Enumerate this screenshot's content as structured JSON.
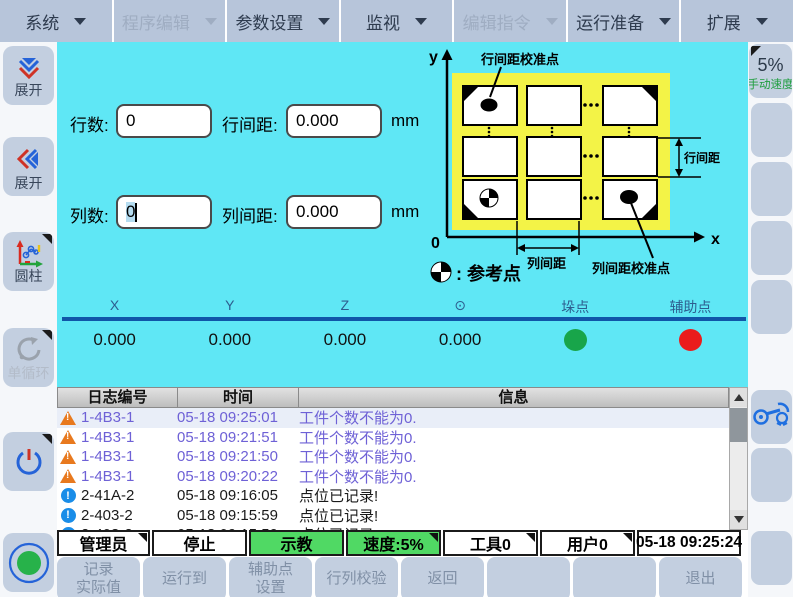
{
  "menu": {
    "items": [
      {
        "label": "系统",
        "disabled": false
      },
      {
        "label": "程序编辑",
        "disabled": true
      },
      {
        "label": "参数设置",
        "disabled": false
      },
      {
        "label": "监视",
        "disabled": false
      },
      {
        "label": "编辑指令",
        "disabled": true
      },
      {
        "label": "运行准备",
        "disabled": false
      },
      {
        "label": "扩展",
        "disabled": false
      }
    ]
  },
  "left_sidebar": {
    "buttons": [
      {
        "label": "展开",
        "icon": "double-chevron-down-icon"
      },
      {
        "label": "展开",
        "icon": "double-chevron-left-icon"
      },
      {
        "label": "圆柱",
        "icon": "robot-coordinate-icon"
      },
      {
        "label": "单循环",
        "icon": "single-cycle-icon",
        "disabled": true
      },
      {
        "label": "",
        "icon": "power-icon"
      },
      {
        "label": "",
        "icon": "servo-on-icon"
      }
    ]
  },
  "right_sidebar": {
    "speed_button": {
      "value": "5%",
      "label": "手动速度"
    },
    "robot_button": {
      "icon": "robot-arm-icon"
    }
  },
  "form": {
    "rows_label": "行数:",
    "rows_value": "0",
    "row_pitch_label": "行间距:",
    "row_pitch_value": "0.000",
    "row_unit": "mm",
    "cols_label": "列数:",
    "cols_value": "0",
    "col_pitch_label": "列间距:",
    "col_pitch_value": "0.000",
    "col_unit": "mm"
  },
  "diagram": {
    "y_axis_label": "y",
    "x_axis_label": "x",
    "origin_label": "0",
    "row_calib_callout": "行间距校准点",
    "col_calib_callout": "列间距校准点",
    "row_pitch_dim": "行间距",
    "col_pitch_dim": "列间距",
    "legend_text": ": 参考点",
    "ellipsis_h": "...",
    "ellipsis_v": "⋮"
  },
  "coords": {
    "headers": [
      "X",
      "Y",
      "Z",
      "⊙",
      "垛点",
      "辅助点"
    ],
    "values": [
      "0.000",
      "0.000",
      "0.000",
      "0.000"
    ],
    "stack_dot_color": "#18a54a",
    "aux_dot_color": "#ea1c1c"
  },
  "log": {
    "headers": [
      "日志编号",
      "时间",
      "信息"
    ],
    "rows": [
      {
        "type": "warning",
        "id": "1-4B3-1",
        "time": "05-18 09:25:01",
        "msg": "工件个数不能为0.",
        "selected": true
      },
      {
        "type": "warning",
        "id": "1-4B3-1",
        "time": "05-18 09:21:51",
        "msg": "工件个数不能为0."
      },
      {
        "type": "warning",
        "id": "1-4B3-1",
        "time": "05-18 09:21:50",
        "msg": "工件个数不能为0."
      },
      {
        "type": "warning",
        "id": "1-4B3-1",
        "time": "05-18 09:20:22",
        "msg": "工件个数不能为0."
      },
      {
        "type": "info",
        "id": "2-41A-2",
        "time": "05-18 09:16:05",
        "msg": "点位已记录!"
      },
      {
        "type": "info",
        "id": "2-403-2",
        "time": "05-18 09:15:59",
        "msg": "点位已记录!"
      },
      {
        "type": "info",
        "id": "2-403-2",
        "time": "05-18 09:15:59",
        "msg": "点位已记录!"
      }
    ]
  },
  "status_bar": {
    "cells": [
      {
        "label": "管理员",
        "corner": true
      },
      {
        "label": "停止"
      },
      {
        "label": "示教",
        "green": true
      },
      {
        "label": "速度:5%",
        "green": true,
        "corner": true
      },
      {
        "label": "工具0",
        "corner": true
      },
      {
        "label": "用户0",
        "corner": true
      },
      {
        "label": "05-18 09:25:24"
      }
    ]
  },
  "bottom_bar": {
    "buttons": [
      {
        "label": "记录\n实际值"
      },
      {
        "label": "运行到"
      },
      {
        "label": "辅助点\n设置"
      },
      {
        "label": "行列校验"
      },
      {
        "label": "返回"
      },
      {
        "label": ""
      },
      {
        "label": ""
      },
      {
        "label": "退出"
      }
    ]
  },
  "colors": {
    "panel_cyan": "#5fe7f5",
    "pallet_yellow": "#f3f347",
    "divider_blue": "#1056a8",
    "status_green": "#50d964",
    "warning_text": "#6e61d6",
    "button_gray_blue": "#c3cfe0"
  }
}
